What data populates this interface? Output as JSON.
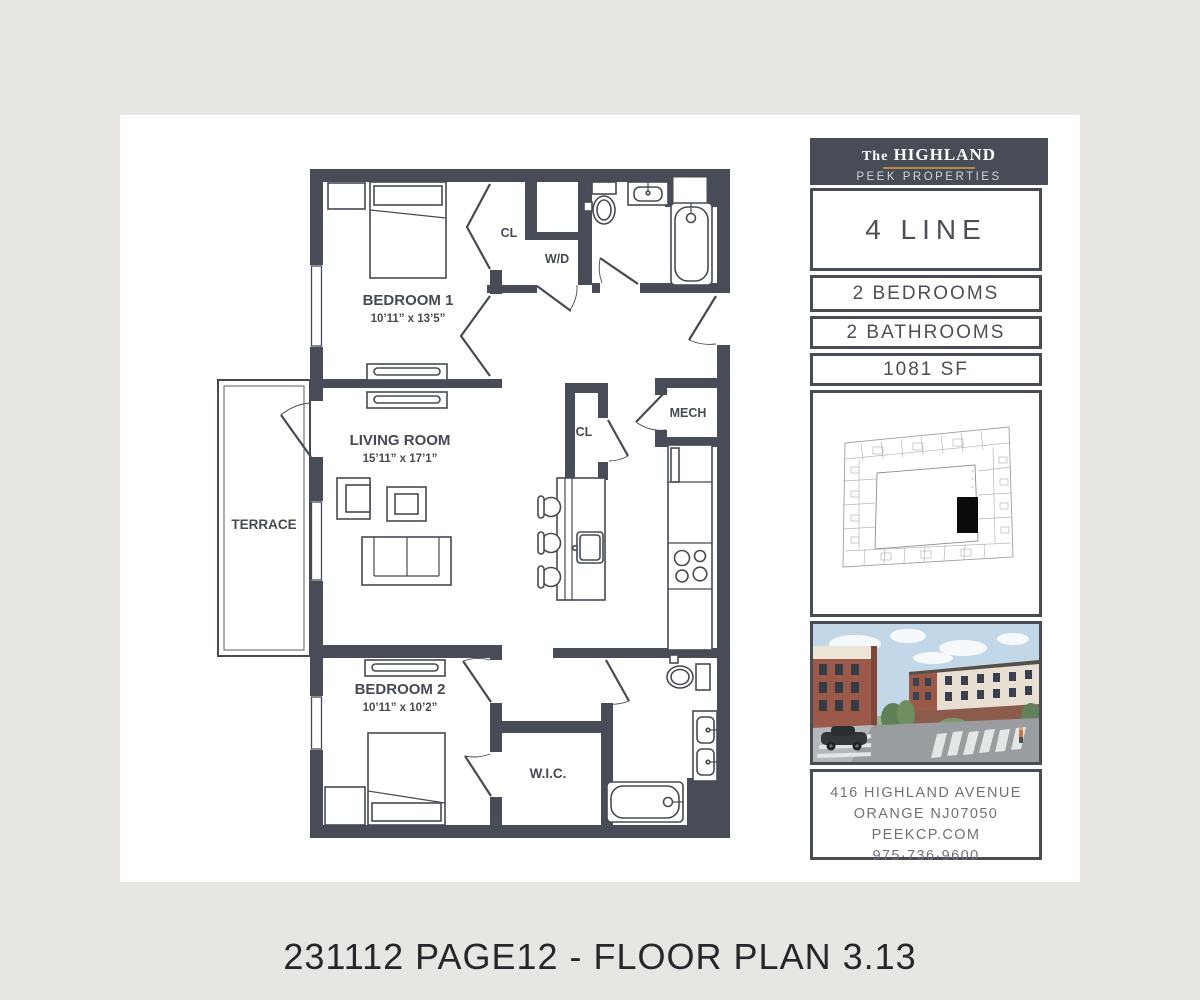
{
  "page": {
    "footer_caption": "231112 PAGE12 - FLOOR PLAN 3.13"
  },
  "brand": {
    "name_prefix": "The",
    "name": "HIGHLAND",
    "subtitle": "PEEK PROPERTIES"
  },
  "unit": {
    "line_name": "4 LINE",
    "bedrooms": "2 BEDROOMS",
    "bathrooms": "2 BATHROOMS",
    "area": "1081 SF"
  },
  "contact": {
    "address_line1": "416 HIGHLAND AVENUE",
    "address_line2": "ORANGE NJ07050",
    "website": "PEEKCP.COM",
    "phone": "975·736·9600"
  },
  "floorplan": {
    "rooms": {
      "bedroom1": {
        "name": "BEDROOM 1",
        "dims": "10’11” x 13’5”"
      },
      "living": {
        "name": "LIVING ROOM",
        "dims": "15’11” x 17’1”"
      },
      "bedroom2": {
        "name": "BEDROOM 2",
        "dims": "10’11” x 10’2”"
      },
      "terrace": {
        "name": "TERRACE"
      },
      "closet1": {
        "name": "CL"
      },
      "laundry": {
        "name": "W/D"
      },
      "mech": {
        "name": "MECH"
      },
      "closet2": {
        "name": "CL"
      },
      "wic": {
        "name": "W.I.C."
      }
    }
  },
  "colors": {
    "wall_ink": "#474c57",
    "gold_accent": "#b5884a",
    "page_background": "#e7e6e3",
    "unit_marker": "#111111"
  }
}
